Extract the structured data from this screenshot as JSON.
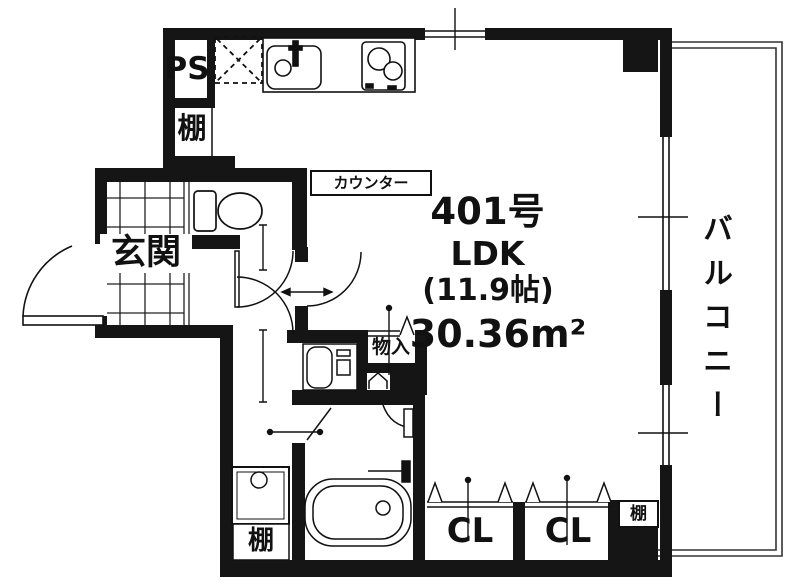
{
  "unit": {
    "number": "401号",
    "layout": "LDK",
    "size_jo": "(11.9帖)",
    "area": "30.36m²"
  },
  "rooms": {
    "entrance": "玄関",
    "balcony": "バルコニー",
    "storage": "物入",
    "closet_left": "CL",
    "closet_right": "CL"
  },
  "labels": {
    "pipe_space": "PS",
    "counter": "カウンター",
    "shelf_kitchen": "棚",
    "shelf_washroom": "棚",
    "shelf_balcony_side": "棚"
  },
  "colors": {
    "wall": "#151515",
    "line": "#222222",
    "background": "#ffffff"
  }
}
